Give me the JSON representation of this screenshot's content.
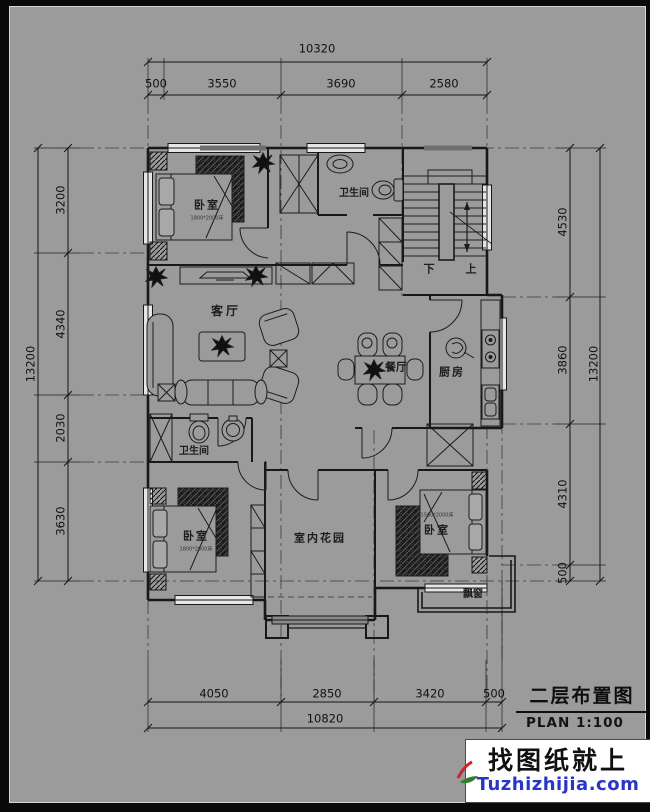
{
  "sheet": {
    "background": "#9b9b9b",
    "line_color": "#1a1a1a"
  },
  "dimensions": {
    "top": {
      "total": "10320",
      "segments": [
        "500",
        "3550",
        "3690",
        "2580"
      ]
    },
    "bottom": {
      "total": "10820",
      "segments": [
        "4050",
        "2850",
        "3420",
        "500"
      ]
    },
    "left": {
      "total": "13200",
      "segments": [
        "3200",
        "4340",
        "2030",
        "3630"
      ]
    },
    "right": {
      "total": "13200",
      "segments": [
        "4530",
        "3860",
        "4310",
        "500"
      ]
    }
  },
  "rooms": {
    "bedroom_top_left": {
      "name": "卧室",
      "bed_size": "1800*2000床"
    },
    "bathroom_top": {
      "name": "卫生间"
    },
    "living_room": {
      "name": "客厅"
    },
    "dining_room": {
      "name": "餐厅"
    },
    "kitchen": {
      "name": "厨房"
    },
    "bathroom_mid": {
      "name": "卫生间"
    },
    "bedroom_bottom_left": {
      "name": "卧室",
      "bed_size": "1800*2000床"
    },
    "indoor_garden": {
      "name": "室内花园"
    },
    "bedroom_bottom_right": {
      "name": "卧室",
      "bed_size": "1500*2000床"
    },
    "bay_window": {
      "name": "飘窗"
    }
  },
  "stairs": {
    "down_label": "下",
    "up_label": "上"
  },
  "title_block": {
    "title": "二层布置图",
    "scale": "PLAN 1:100"
  },
  "watermark": {
    "line1": "找图纸就上",
    "line2": "Tuzhizhijia.com",
    "text_color": "#101010",
    "link_color": "#2a35c8"
  }
}
